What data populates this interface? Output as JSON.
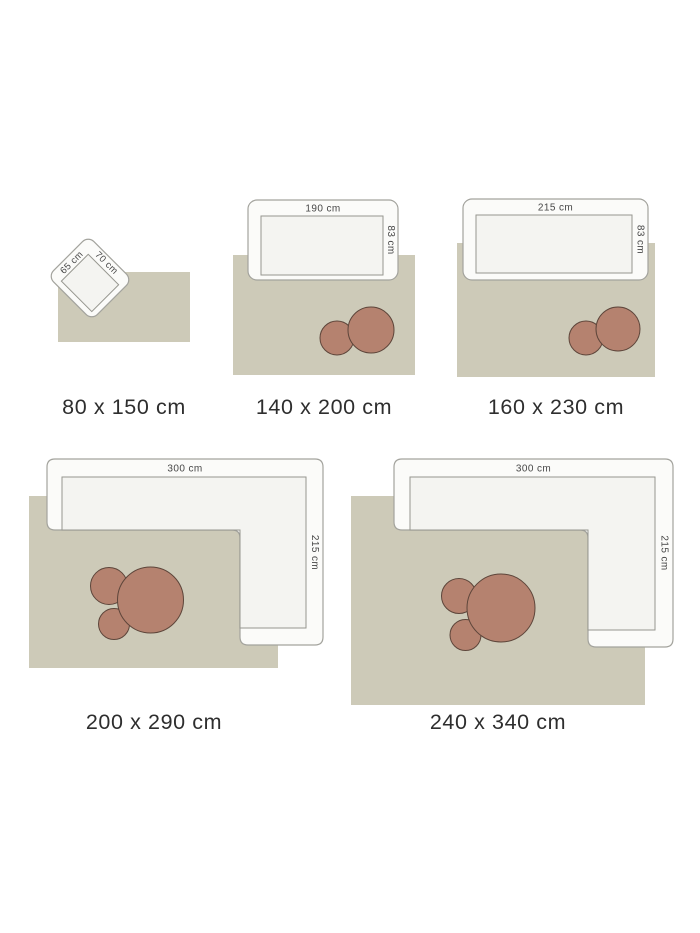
{
  "diagram": "rug-size-guide",
  "colors": {
    "background": "#ffffff",
    "rug": "#cdcab8",
    "furniture_fill": "#fbfbf9",
    "furniture_seat_fill": "#f4f4f1",
    "furniture_border": "#a3a39d",
    "table_fill": "#b5826f",
    "table_border": "#5d453a",
    "dimension_text": "#474747",
    "caption_text": "#2e2e2e"
  },
  "panels": [
    {
      "caption": "80 x 150 cm",
      "item": {
        "width_label": "65 cm",
        "depth_label": "70 cm"
      }
    },
    {
      "caption": "140 x 200 cm",
      "sofa": {
        "width_label": "190 cm",
        "depth_label": "83 cm"
      }
    },
    {
      "caption": "160 x 230 cm",
      "sofa": {
        "width_label": "215 cm",
        "depth_label": "83 cm"
      }
    },
    {
      "caption": "200 x 290 cm",
      "sofa": {
        "width_label": "300 cm",
        "depth_label": "215 cm"
      }
    },
    {
      "caption": "240 x 340 cm",
      "sofa": {
        "width_label": "300 cm",
        "depth_label": "215 cm"
      }
    }
  ]
}
